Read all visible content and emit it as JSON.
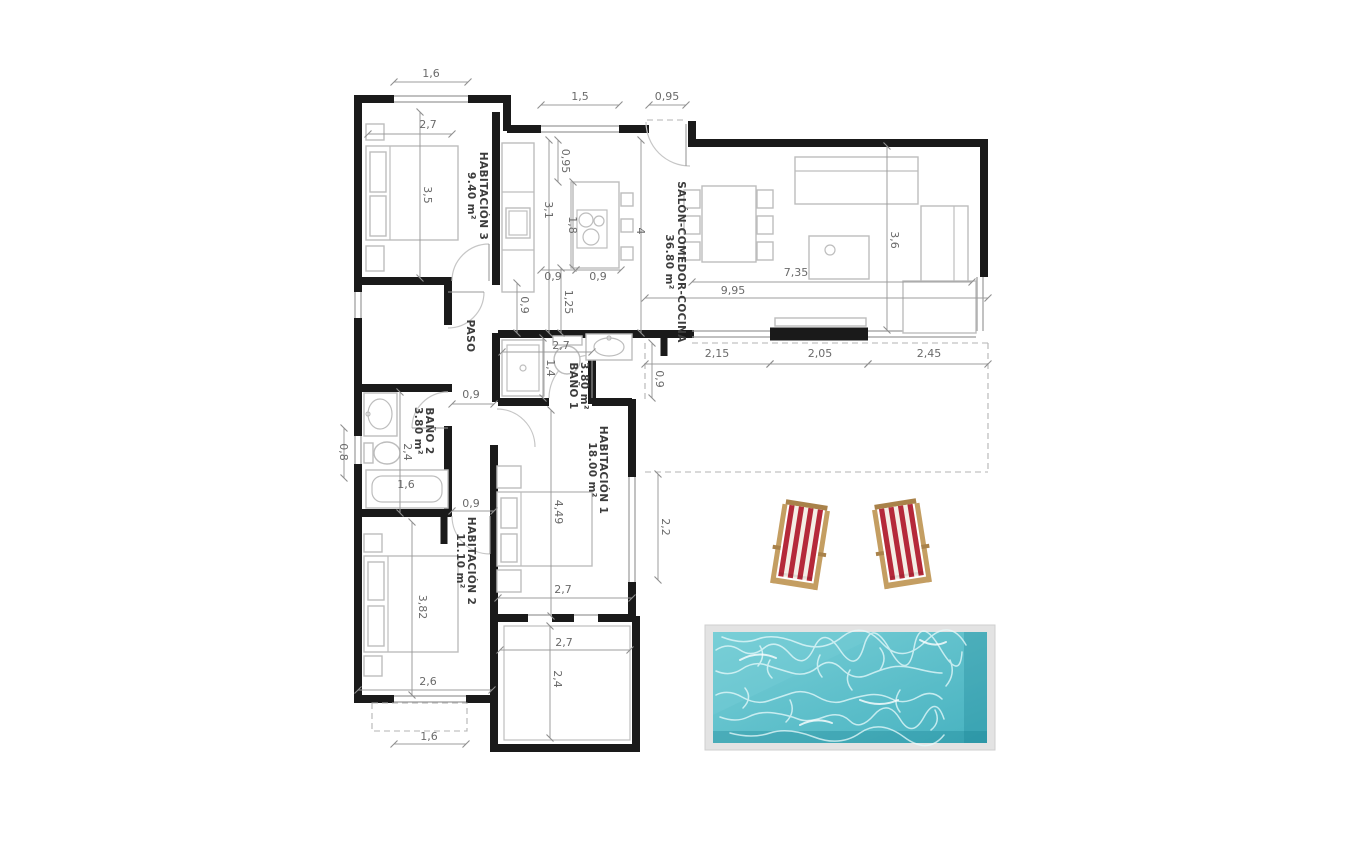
{
  "plan_title": "floor-plan",
  "rooms": {
    "habitacion3": {
      "label": "HABITACIÓN 3",
      "area": "9.40 m²"
    },
    "salon": {
      "label": "SALÓN-COMEDOR-COCINA",
      "area": "36.80 m²"
    },
    "paso": {
      "label": "PASO",
      "area": ""
    },
    "bano1": {
      "label": "BAÑO 1",
      "area": "3.80 m²"
    },
    "bano2": {
      "label": "BAÑO 2",
      "area": "3.80 m²"
    },
    "habitacion1": {
      "label": "HABITACIÓN 1",
      "area": "18.00 m²"
    },
    "habitacion2": {
      "label": "HABITACIÓN 2",
      "area": "11.10 m²"
    }
  },
  "dims": {
    "top_window": "1,6",
    "hab3_width": "2,7",
    "hab3_depth": "3,5",
    "kitchen_window": "1,5",
    "entry_door": "0,95",
    "kitchen_top": "0,95",
    "kitchen_left": "3,1",
    "island": "1,8",
    "kitchen_span": "4",
    "counter_a": "0,9",
    "counter_b": "0,9",
    "kitchen_pass": "1,25",
    "kitchen_col": "0,9",
    "salon_inner": "7,35",
    "salon_total": "9,95",
    "salon_depth": "3,6",
    "terrace_a": "2,15",
    "terrace_b": "2,05",
    "terrace_c": "2,45",
    "terrace_d": "0,9",
    "bano1_w": "2,7",
    "bano1_d": "1,4",
    "hall_a": "0,9",
    "bano2_d": "2,4",
    "ext_left": "0,8",
    "bath_tub": "1,6",
    "hall_b": "0,9",
    "hab1_len": "4,49",
    "hab1_win": "2,2",
    "hab1_w": "2,7",
    "porch_w": "2,7",
    "porch_d": "2,4",
    "hab2_len": "3,82",
    "hab2_w": "2,6",
    "hab2_win": "1,6"
  },
  "colors": {
    "wall": "#1a1a1a",
    "pool_border": "#e3e3e3",
    "water_light": "#79cfd7",
    "water_deep": "#47b2c0",
    "water_dark": "#157f8f",
    "ripple": "#eafbfc",
    "chair_red": "#b5293a",
    "chair_white": "#f4eee6",
    "chair_wood": "#c49e62",
    "chair_wood_dark": "#a9824a"
  }
}
